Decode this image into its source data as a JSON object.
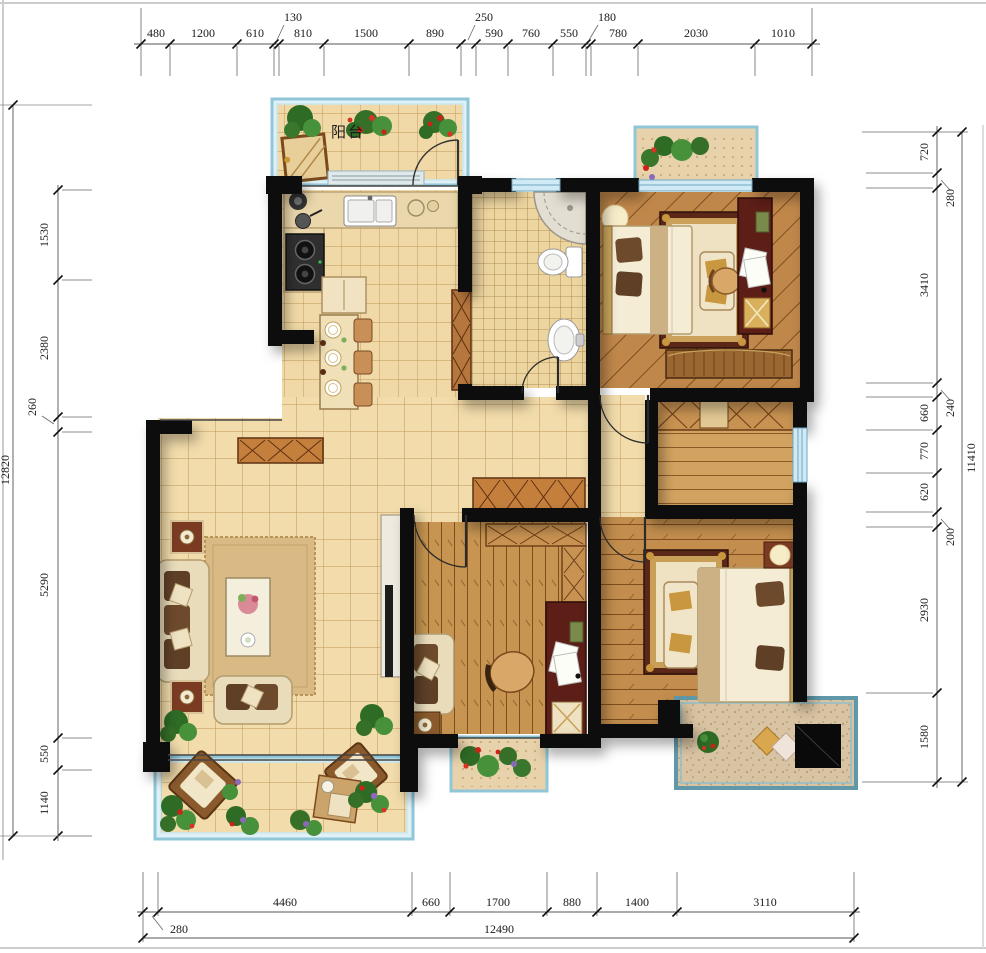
{
  "drawing": {
    "type": "residential floor plan",
    "units": "mm"
  },
  "rooms": {
    "balcony_label": "阳台"
  },
  "dims": {
    "top": {
      "values": [
        "480",
        "1200",
        "610",
        "130",
        "810",
        "1500",
        "890",
        "250",
        "590",
        "760",
        "550",
        "180",
        "780",
        "2030",
        "1010"
      ]
    },
    "left": {
      "values": [
        "1530",
        "2380",
        "260",
        "5290",
        "550",
        "1140"
      ],
      "total": "12820"
    },
    "right": {
      "values": [
        "720",
        "280",
        "3410",
        "240",
        "660",
        "770",
        "620",
        "200",
        "2930",
        "1580"
      ],
      "total": "11410"
    },
    "bottom": {
      "values": [
        "280",
        "4460",
        "660",
        "1700",
        "880",
        "1400",
        "3110"
      ],
      "total": "12490"
    }
  },
  "colors": {
    "wall": "#0d0d0d",
    "tile_floor": "#f2dcab",
    "wood_floor": "#c28d4d",
    "window_glass": "#cfeaf4",
    "balcony_frame": "#8fc6d8",
    "teal_frame": "#5f98a8",
    "desk_mahogany": "#5c1e16",
    "cabinet_wood": "#c47f3c"
  }
}
